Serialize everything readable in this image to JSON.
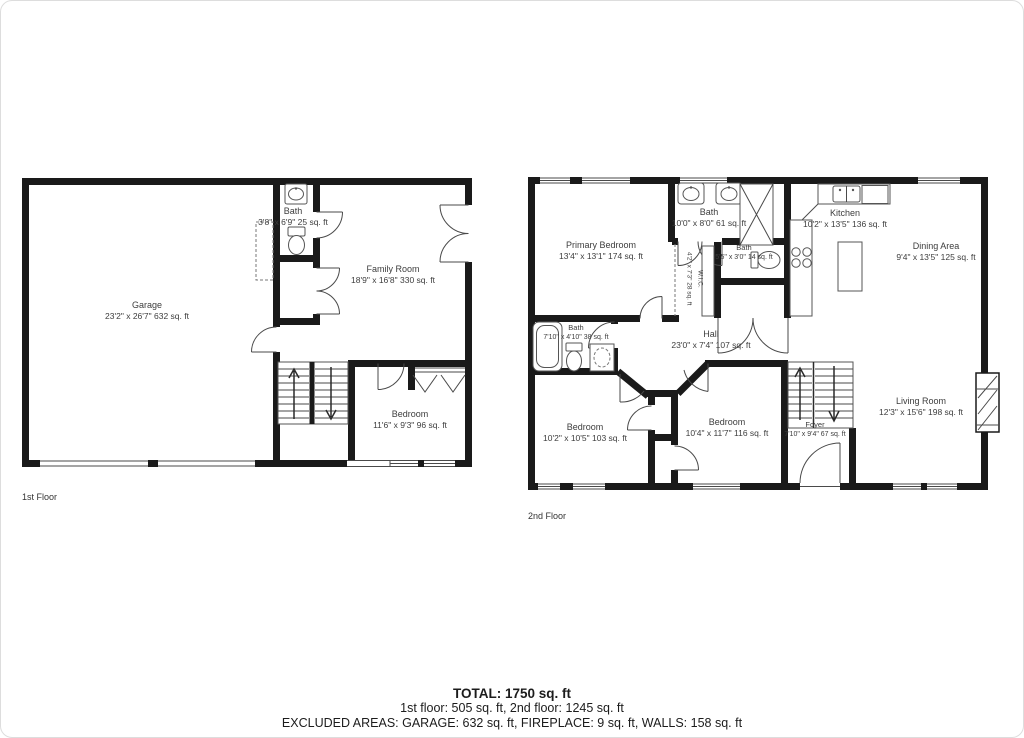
{
  "image": {
    "type": "floor-plan",
    "background": "#ffffff",
    "wall_color": "#1a1a1a",
    "text_color": "#3d3d3d"
  },
  "floor1": {
    "label": "1st Floor",
    "rooms": [
      {
        "name": "Garage",
        "dims": "23'2\" x 26'7\" 632 sq. ft"
      },
      {
        "name": "Bath",
        "dims": "3'8\" x 6'9\" 25 sq. ft"
      },
      {
        "name": "Family Room",
        "dims": "18'9\" x 16'8\" 330 sq. ft"
      },
      {
        "name": "Bedroom",
        "dims": "11'6\" x 9'3\" 96 sq. ft"
      }
    ]
  },
  "floor2": {
    "label": "2nd Floor",
    "rooms": [
      {
        "name": "Primary Bedroom",
        "dims": "13'4\" x 13'1\" 174 sq. ft"
      },
      {
        "name": "Bath",
        "dims": "10'0\" x 8'0\" 61 sq. ft"
      },
      {
        "name": "Bath",
        "dims": "5'5\" x 3'0\" 14 sq. ft"
      },
      {
        "name": "W.I.C.",
        "dims": "4'2\" x 7'3\" 28 sq. ft"
      },
      {
        "name": "Kitchen",
        "dims": "10'2\" x 13'5\" 136 sq. ft"
      },
      {
        "name": "Dining Area",
        "dims": "9'4\" x 13'5\" 125 sq. ft"
      },
      {
        "name": "Hall",
        "dims": "23'0\" x 7'4\" 107 sq. ft"
      },
      {
        "name": "Bath",
        "dims": "7'10\" x 4'10\" 38 sq. ft"
      },
      {
        "name": "Bedroom",
        "dims": "10'2\" x 10'5\" 103 sq. ft"
      },
      {
        "name": "Bedroom",
        "dims": "10'4\" x 11'7\" 116 sq. ft"
      },
      {
        "name": "Foyer",
        "dims": "7'10\" x 9'4\" 67 sq. ft"
      },
      {
        "name": "Living Room",
        "dims": "12'3\" x 15'6\" 198 sq. ft"
      }
    ]
  },
  "summary": {
    "total": "TOTAL: 1750 sq. ft",
    "floors": "1st floor: 505 sq. ft, 2nd floor: 1245 sq. ft",
    "excluded": "EXCLUDED AREAS: GARAGE: 632 sq. ft, FIREPLACE: 9 sq. ft, WALLS: 158 sq. ft"
  }
}
